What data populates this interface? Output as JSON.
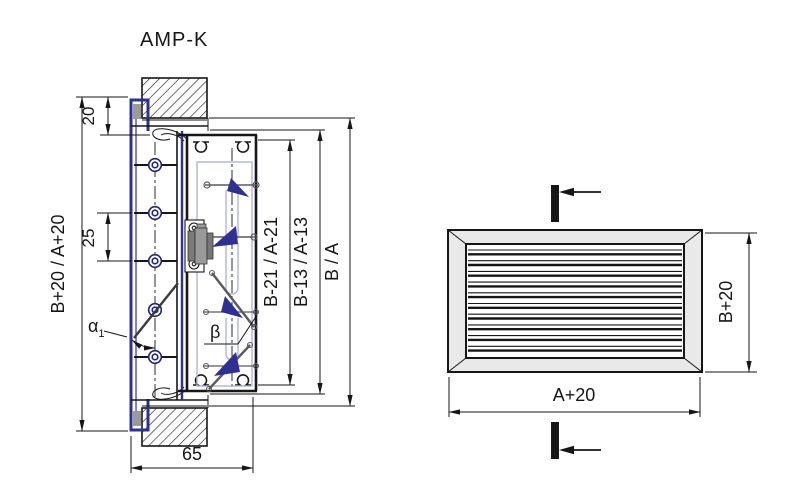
{
  "title": "AMP-K",
  "section_view": {
    "dims": {
      "flange_depth": "20",
      "louver_pitch": "25",
      "overall_height": "B+20 / A+20",
      "inner_clear": "B-21 / A-21",
      "frame_inner": "B-13 / A-13",
      "nominal": "B / A",
      "total_depth": "65"
    },
    "angles": {
      "alpha": "α",
      "alpha_sub": "1",
      "beta": "β"
    },
    "louver_axle_count": 5
  },
  "front_view": {
    "dims": {
      "width": "A+20",
      "height": "B+20"
    },
    "louver_count": 10
  },
  "colors": {
    "frame_blue": "#2e3192",
    "blade_wedge_blue": "#2e3192",
    "liner_lavender": "#b4b4d9",
    "metal_gray": "#9a9a9a",
    "panel_gray": "#e9e9e9",
    "line_black": "#161616"
  }
}
